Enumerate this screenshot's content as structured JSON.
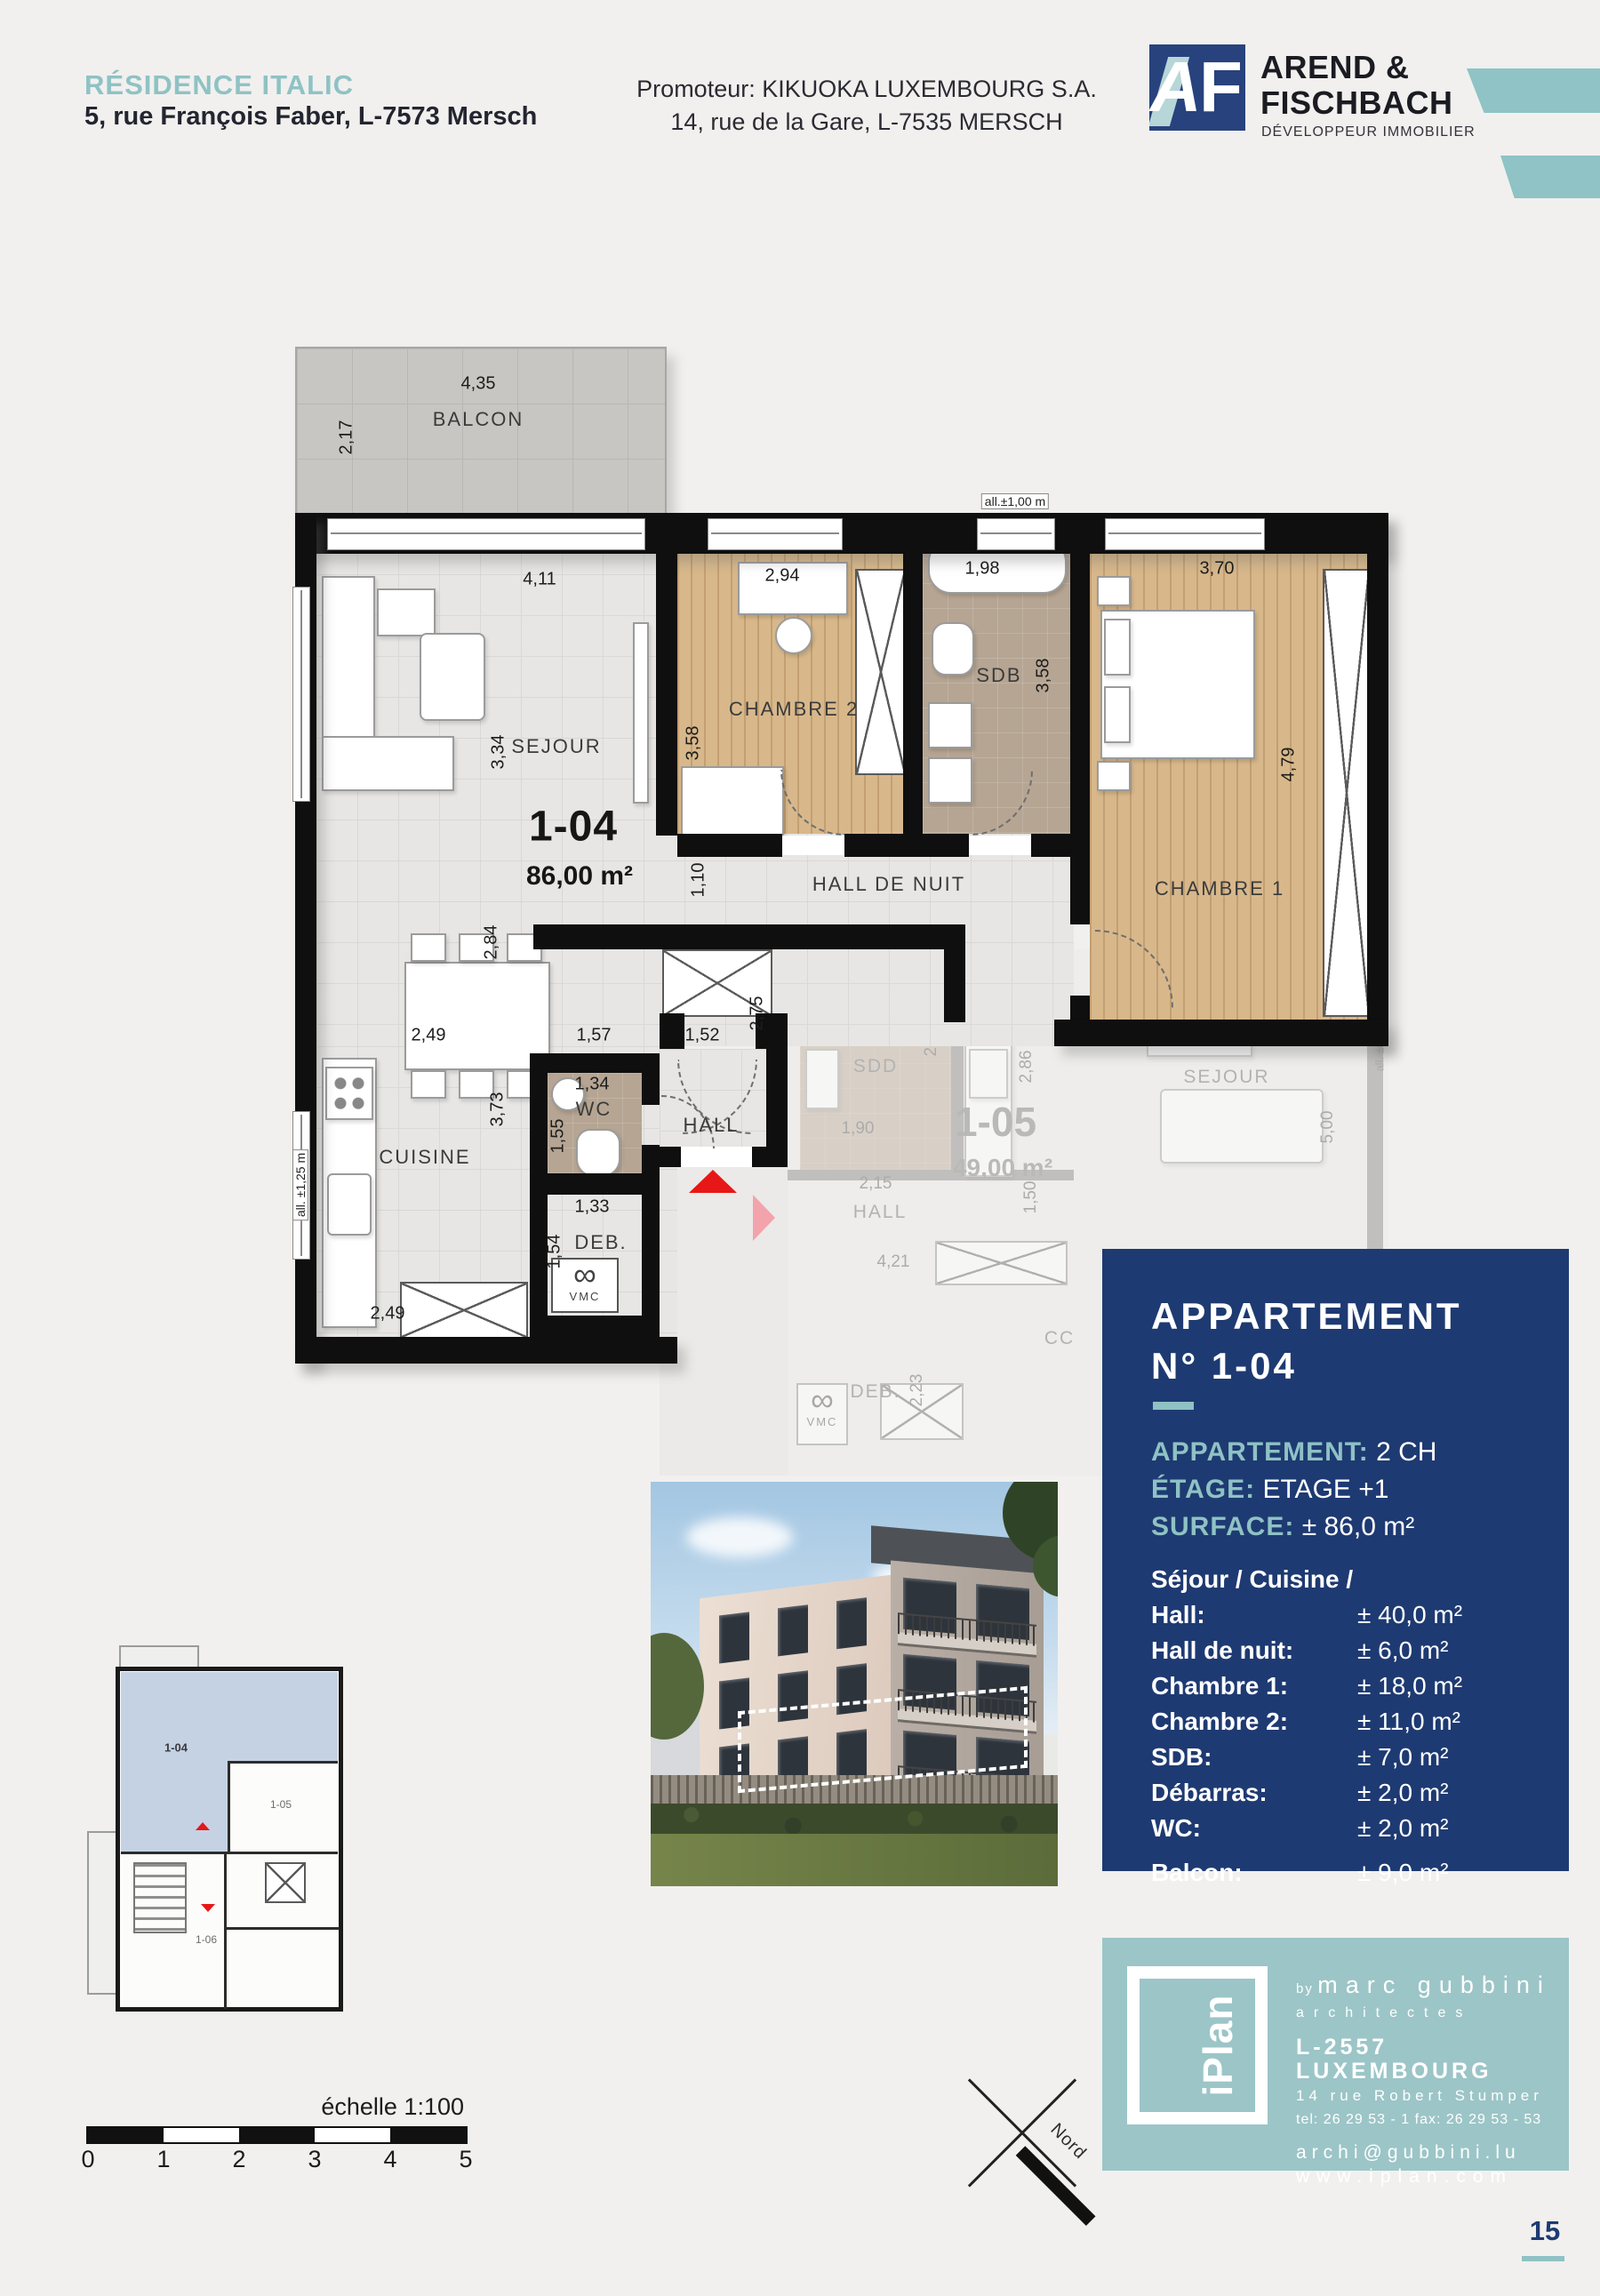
{
  "header": {
    "project_title": "RÉSIDENCE ITALIC",
    "project_address": "5, rue François Faber, L-7573 Mersch",
    "promoter_line1": "Promoteur: KIKUOKA LUXEMBOURG S.A.",
    "promoter_line2": "14, rue de la Gare, L-7535 MERSCH",
    "logo_letter_a": "A",
    "logo_letter_f": "F",
    "developer_line1": "AREND &",
    "developer_line2": "FISCHBACH",
    "developer_tagline": "DÉVELOPPEUR IMMOBILIER"
  },
  "colors": {
    "teal": "#8fc2c4",
    "navy": "#1e3a72",
    "entry_arrow_red": "#e81717",
    "mini_plan_highlight": "#c5d2e4"
  },
  "plan": {
    "unit_id": "1-04",
    "unit_area": "86,00 m²",
    "room_labels": {
      "balcon": "BALCON",
      "sejour": "SEJOUR",
      "chambre2": "CHAMBRE 2",
      "sdb": "SDB",
      "chambre1": "CHAMBRE 1",
      "hall_de_nuit": "HALL DE NUIT",
      "cuisine": "CUISINE",
      "wc": "WC",
      "hall": "HALL",
      "deb": "DEB.",
      "vmc": "VMC"
    },
    "window_labels": {
      "sdb": "all.±1,00 m",
      "cuisine": "all. ±1,25 m"
    },
    "dims": {
      "balcon_w": "4,35",
      "balcon_h": "2,17",
      "sejour_w": "4,11",
      "sejour_h": "3,34",
      "chambre2_w": "2,94",
      "chambre2_h": "3,58",
      "sdb_w": "1,98",
      "sdb_h": "3,58",
      "chambre1_w": "3,70",
      "chambre1_h": "4,79",
      "corridor_h": "1,10",
      "dining_h": "2,84",
      "cuisine_top": "2,49",
      "wc_top": "1,57",
      "hall_top": "1,52",
      "hall_side": "2,75",
      "cuisine_h": "3,73",
      "wc_w": "1,34",
      "wc_h": "1,55",
      "deb_w": "1,33",
      "deb_h": "1,54",
      "cuisine_bottom": "2,49"
    }
  },
  "ghost": {
    "unit_id": "1-05",
    "unit_area": "49,00 m²",
    "room_labels": {
      "sdd": "SDD",
      "cuisine": "CUISINE",
      "sejour": "SEJOUR",
      "hall": "HALL",
      "deb": "DEB.",
      "cc": "CC",
      "vmc": "VMC"
    },
    "window_label": "all. ±0,18 m",
    "dims": {
      "sdd_h": "2,74",
      "sdd_w": "1,90",
      "cuisine_h": "2,86",
      "sejour_h": "5,00",
      "hall_w": "2,15",
      "hall_h": "1,50",
      "hall_len": "4,21",
      "deb_h": "2,23"
    }
  },
  "info_panel": {
    "title_line1": "APPARTEMENT",
    "title_line2": "N° 1-04",
    "specs": [
      {
        "label": "APPARTEMENT:",
        "value": "2 CH"
      },
      {
        "label": "ÉTAGE:",
        "value": "ETAGE +1"
      },
      {
        "label": "SURFACE:",
        "value": "± 86,0 m²"
      }
    ],
    "rooms": [
      {
        "label": "Séjour / Cuisine /",
        "value": ""
      },
      {
        "label": "Hall:",
        "value": "± 40,0 m²"
      },
      {
        "label": "Hall de nuit:",
        "value": "± 6,0 m²"
      },
      {
        "label": "Chambre 1:",
        "value": "± 18,0 m²"
      },
      {
        "label": "Chambre 2:",
        "value": "± 11,0 m²"
      },
      {
        "label": "SDB:",
        "value": "± 7,0 m²"
      },
      {
        "label": "Débarras:",
        "value": "± 2,0 m²"
      },
      {
        "label": "WC:",
        "value": "± 2,0 m²"
      }
    ],
    "balcony": {
      "label": "Balcon:",
      "value": "± 9,0 m²"
    }
  },
  "mini_plan": {
    "unit1": "1-04",
    "unit2": "1-05",
    "unit3": "1-06"
  },
  "scale_bar": {
    "label": "échelle 1:100",
    "ticks": [
      "0",
      "1",
      "2",
      "3",
      "4",
      "5"
    ]
  },
  "north": {
    "label": "Nord"
  },
  "iplan": {
    "logo_text": "iPlan",
    "by_prefix": "by",
    "by_name": "marc gubbini",
    "by_suffix": "architectes",
    "address_line1": "L-2557 LUXEMBOURG",
    "address_line2": "14 rue Robert Stumper",
    "phone_line": "tel: 26 29 53 - 1    fax: 26 29 53 - 53",
    "email": "archi@gubbini.lu",
    "web": "www.iplan.com"
  },
  "page_number": "15"
}
